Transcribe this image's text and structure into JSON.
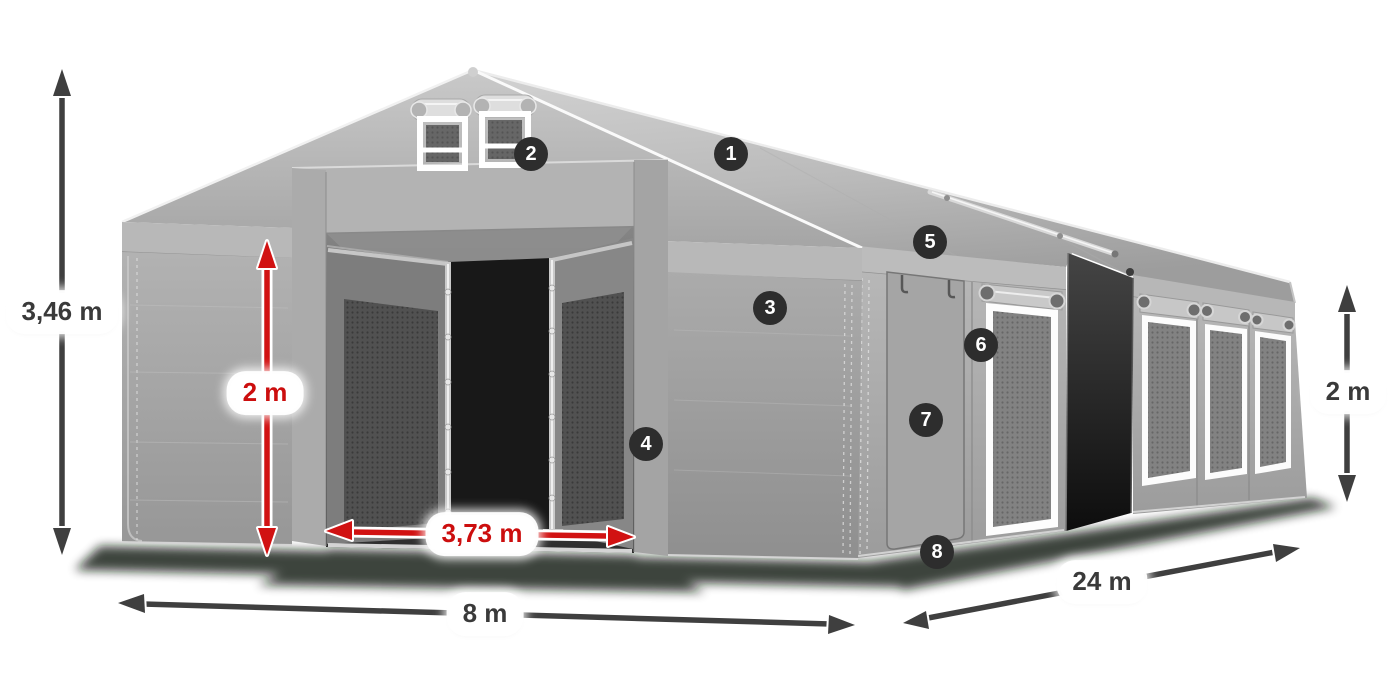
{
  "diagram": {
    "title": "Tent dimensions diagram",
    "dimensions": {
      "total_height": "3,46 m",
      "entrance_height": "2 m",
      "entrance_width": "3,73 m",
      "front_width": "8 m",
      "side_length": "24 m",
      "side_wall_height": "2 m"
    },
    "markers": [
      {
        "number": "1"
      },
      {
        "number": "2"
      },
      {
        "number": "3"
      },
      {
        "number": "4"
      },
      {
        "number": "5"
      },
      {
        "number": "6"
      },
      {
        "number": "7"
      },
      {
        "number": "8"
      }
    ],
    "colors": {
      "arrow_dark": "#3f3f3f",
      "arrow_red": "#d11212",
      "label_dark": "#3a3a3a",
      "label_red": "#cc0e0e",
      "marker_bg": "#2d2d2d",
      "marker_fg": "#ffffff",
      "bg": "#ffffff"
    }
  }
}
